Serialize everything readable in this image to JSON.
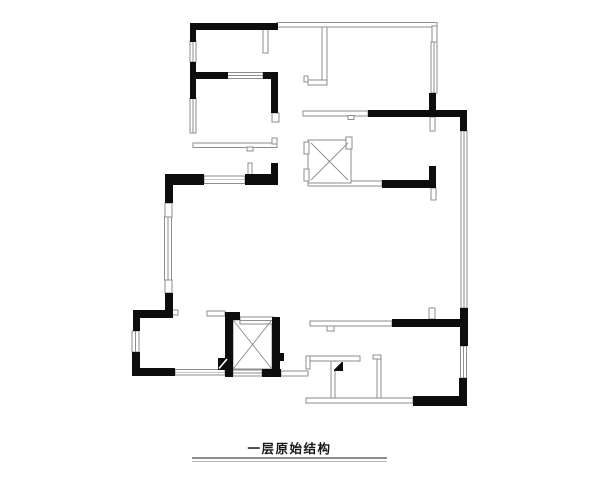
{
  "title": {
    "text": "一层原始结构"
  },
  "colors": {
    "wall": "#0d0d0d",
    "line": "#8e8e8e",
    "bg": "#ffffff",
    "title": "#1a1a1a",
    "ul1": "#8f8f8f",
    "ul2": "#b5b5b5"
  },
  "plan": {
    "walls": [
      {
        "x": 190,
        "y": 23,
        "w": 88,
        "h": 7,
        "name": "wall-top-room1"
      },
      {
        "x": 190,
        "y": 29,
        "w": 6,
        "h": 13,
        "name": "wall-left-upper-a"
      },
      {
        "x": 190,
        "y": 62,
        "w": 6,
        "h": 37,
        "name": "wall-left-upper-b"
      },
      {
        "x": 190,
        "y": 72,
        "w": 38,
        "h": 7,
        "name": "wall-room1-south-left"
      },
      {
        "x": 263,
        "y": 72,
        "w": 15,
        "h": 7,
        "name": "wall-room1-south-right"
      },
      {
        "x": 271,
        "y": 72,
        "w": 7,
        "h": 41,
        "name": "wall-room1-east"
      },
      {
        "x": 165,
        "y": 174,
        "w": 39,
        "h": 11,
        "name": "wall-corridor-left"
      },
      {
        "x": 245,
        "y": 174,
        "w": 33,
        "h": 11,
        "name": "wall-corridor-right"
      },
      {
        "x": 271,
        "y": 163,
        "w": 7,
        "h": 12,
        "name": "wall-corridor-stub-up"
      },
      {
        "x": 165,
        "y": 182,
        "w": 8,
        "h": 21,
        "name": "wall-left-mid-a"
      },
      {
        "x": 165,
        "y": 293,
        "w": 8,
        "h": 25,
        "name": "wall-left-mid-b"
      },
      {
        "x": 133,
        "y": 310,
        "w": 39,
        "h": 8,
        "name": "wall-room4-north"
      },
      {
        "x": 133,
        "y": 310,
        "w": 7,
        "h": 21,
        "name": "wall-room4-west-a"
      },
      {
        "x": 132,
        "y": 352,
        "w": 8,
        "h": 24,
        "name": "wall-room4-west-b"
      },
      {
        "x": 133,
        "y": 368,
        "w": 42,
        "h": 8,
        "name": "wall-room4-south"
      },
      {
        "x": 225,
        "y": 312,
        "w": 8,
        "h": 65,
        "name": "wall-shaft2-west"
      },
      {
        "x": 225,
        "y": 312,
        "w": 15,
        "h": 8,
        "name": "wall-shaft2-north-corner"
      },
      {
        "x": 272,
        "y": 317,
        "w": 8,
        "h": 60,
        "name": "wall-shaft2-east"
      },
      {
        "x": 280,
        "y": 353,
        "w": 4,
        "h": 8,
        "name": "wall-shaft2-east-tab"
      },
      {
        "x": 262,
        "y": 369,
        "w": 19,
        "h": 8,
        "name": "wall-shaft2-south"
      },
      {
        "x": 218,
        "y": 358,
        "w": 10,
        "h": 12,
        "name": "column-shaft2-corner"
      },
      {
        "x": 392,
        "y": 319,
        "w": 70,
        "h": 8,
        "name": "wall-lower-mid-black"
      },
      {
        "x": 460,
        "y": 308,
        "w": 8,
        "h": 38,
        "name": "wall-right-a"
      },
      {
        "x": 459,
        "y": 378,
        "w": 8,
        "h": 28,
        "name": "wall-right-b"
      },
      {
        "x": 413,
        "y": 396,
        "w": 50,
        "h": 10,
        "name": "wall-bottom-right"
      },
      {
        "x": 368,
        "y": 110,
        "w": 99,
        "h": 7,
        "name": "wall-upper-mid-black"
      },
      {
        "x": 460,
        "y": 110,
        "w": 7,
        "h": 21,
        "name": "wall-right-top-corner"
      },
      {
        "x": 429,
        "y": 93,
        "w": 7,
        "h": 19,
        "name": "wall-entry-top"
      },
      {
        "x": 429,
        "y": 166,
        "w": 7,
        "h": 22,
        "name": "wall-entry-stub"
      },
      {
        "x": 382,
        "y": 180,
        "w": 54,
        "h": 8,
        "name": "wall-hall-black"
      },
      {
        "x": 334,
        "y": 362,
        "w": 9,
        "h": 9,
        "name": "column-terrace"
      }
    ],
    "windows": [
      {
        "x": 190,
        "y": 41,
        "w": 6,
        "h": 21,
        "o": "v",
        "name": "window-left-1"
      },
      {
        "x": 190,
        "y": 98,
        "w": 6,
        "h": 35,
        "o": "v",
        "name": "window-left-2"
      },
      {
        "x": 227,
        "y": 72.5,
        "w": 36,
        "h": 6,
        "o": "h",
        "name": "window-room1-south"
      },
      {
        "x": 204,
        "y": 176,
        "w": 41,
        "h": 7.5,
        "o": "h",
        "name": "window-corridor-wall"
      },
      {
        "x": 164.5,
        "y": 217,
        "w": 7,
        "h": 63,
        "o": "v",
        "name": "window-left-mid"
      },
      {
        "x": 132,
        "y": 331,
        "w": 7,
        "h": 21,
        "o": "v",
        "name": "window-room4-west"
      },
      {
        "x": 175,
        "y": 369.5,
        "w": 50,
        "h": 5.5,
        "o": "h",
        "name": "window-room4-south"
      },
      {
        "x": 240,
        "y": 317,
        "w": 33,
        "h": 7,
        "o": "h",
        "name": "window-shaft2-north"
      },
      {
        "x": 233,
        "y": 370,
        "w": 29,
        "h": 6,
        "o": "h",
        "name": "window-shaft2-south"
      },
      {
        "x": 431,
        "y": 42,
        "w": 6,
        "h": 51,
        "o": "v",
        "name": "window-right-top"
      },
      {
        "x": 461,
        "y": 131,
        "w": 6,
        "h": 177,
        "o": "v",
        "name": "window-right-long"
      },
      {
        "x": 460.5,
        "y": 346,
        "w": 6,
        "h": 32,
        "o": "v",
        "name": "window-right-low"
      }
    ],
    "stubs": [
      {
        "x": 165,
        "y": 203,
        "w": 7,
        "h": 14,
        "name": "stub-left-mid-cap-top"
      },
      {
        "x": 165,
        "y": 280,
        "w": 7,
        "h": 13,
        "name": "stub-left-mid-cap-bottom"
      },
      {
        "x": 272,
        "y": 113,
        "w": 7,
        "h": 9,
        "name": "stub-room1-east-cap"
      },
      {
        "x": 172,
        "y": 310,
        "w": 6,
        "h": 5,
        "name": "stub-room4-door-jamb"
      },
      {
        "x": 248,
        "y": 163,
        "w": 4,
        "h": 12,
        "name": "stub-corridor-tick"
      },
      {
        "x": 430,
        "y": 117,
        "w": 5,
        "h": 14,
        "name": "stub-entry-below-wall"
      },
      {
        "x": 431,
        "y": 188,
        "w": 5,
        "h": 12,
        "name": "stub-hall-below-wall"
      },
      {
        "x": 429,
        "y": 308,
        "w": 6,
        "h": 11,
        "name": "stub-above-lower-wall"
      },
      {
        "x": 207,
        "y": 311,
        "w": 18,
        "h": 5,
        "name": "stub-shaft2-west-link"
      }
    ],
    "outlines": [
      {
        "x": 277,
        "y": 22.5,
        "w": 160,
        "h": 4.5,
        "name": "outline-top-line"
      },
      {
        "x": 432,
        "y": 26,
        "w": 5,
        "h": 17,
        "name": "outline-top-right-corner"
      },
      {
        "x": 263,
        "y": 29,
        "w": 5,
        "h": 24,
        "name": "outline-room1-stub"
      },
      {
        "x": 322,
        "y": 27,
        "w": 5,
        "h": 55,
        "name": "outline-partition-vert"
      },
      {
        "x": 308,
        "y": 80,
        "w": 19,
        "h": 5,
        "name": "outline-partition-foot"
      },
      {
        "x": 304,
        "y": 76,
        "w": 4,
        "h": 6,
        "name": "outline-partition-foot-tick"
      },
      {
        "x": 193,
        "y": 143,
        "w": 84,
        "h": 4.5,
        "name": "outline-room2-partition"
      },
      {
        "x": 247,
        "y": 147,
        "w": 6,
        "h": 4,
        "name": "outline-room2-door-notch"
      },
      {
        "x": 272,
        "y": 138,
        "w": 5,
        "h": 6,
        "name": "outline-room2-hook"
      },
      {
        "x": 303,
        "y": 111,
        "w": 65,
        "h": 5,
        "name": "outline-corridor-upper"
      },
      {
        "x": 348,
        "y": 115.5,
        "w": 6,
        "h": 4,
        "name": "outline-corridor-upper-notch"
      },
      {
        "x": 310,
        "y": 321,
        "w": 82,
        "h": 5,
        "name": "outline-corridor-lower"
      },
      {
        "x": 327,
        "y": 326,
        "w": 7,
        "h": 5,
        "name": "outline-corridor-lower-notch"
      },
      {
        "x": 308,
        "y": 181,
        "w": 74,
        "h": 5,
        "name": "outline-hall-line"
      },
      {
        "x": 306,
        "y": 356,
        "w": 54,
        "h": 5,
        "name": "outline-terrace-partition"
      },
      {
        "x": 306,
        "y": 356,
        "w": 4,
        "h": 13,
        "name": "outline-terrace-partition-cap"
      },
      {
        "x": 331,
        "y": 361,
        "w": 4,
        "h": 40,
        "name": "outline-terrace-v1"
      },
      {
        "x": 377,
        "y": 359,
        "w": 4,
        "h": 43,
        "name": "outline-terrace-v2"
      },
      {
        "x": 373,
        "y": 355,
        "w": 8,
        "h": 4,
        "name": "outline-terrace-v2-hook"
      },
      {
        "x": 306,
        "y": 398,
        "w": 107,
        "h": 5,
        "name": "outline-terrace-bottom"
      },
      {
        "x": 281,
        "y": 371,
        "w": 27,
        "h": 5,
        "name": "outline-terrace-bridge"
      },
      {
        "x": 308,
        "y": 140,
        "w": 43,
        "h": 43,
        "name": "outline-shaft1-box"
      },
      {
        "x": 304,
        "y": 142,
        "w": 5,
        "h": 12,
        "name": "outline-shaft1-jamb-top"
      },
      {
        "x": 304,
        "y": 169,
        "w": 5,
        "h": 12,
        "name": "outline-shaft1-jamb-bottom"
      },
      {
        "x": 346,
        "y": 137,
        "w": 6,
        "h": 12,
        "name": "outline-shaft1-tab"
      },
      {
        "x": 233,
        "y": 320,
        "w": 39,
        "h": 49,
        "name": "outline-shaft2-box"
      }
    ],
    "crosses": [
      {
        "x1": 311,
        "y1": 143,
        "x2": 348,
        "y2": 180,
        "name": "shaft1-diagonal-1"
      },
      {
        "x1": 348,
        "y1": 143,
        "x2": 311,
        "y2": 180,
        "name": "shaft1-diagonal-2"
      },
      {
        "x1": 233.5,
        "y1": 320.5,
        "x2": 271.5,
        "y2": 368.5,
        "name": "shaft2-diagonal-1"
      },
      {
        "x1": 271.5,
        "y1": 320.5,
        "x2": 233.5,
        "y2": 368.5,
        "name": "shaft2-diagonal-2"
      }
    ],
    "marks": [
      {
        "type": "line",
        "x1": 219,
        "y1": 368.5,
        "x2": 227,
        "y2": 359,
        "name": "column-corner-slash"
      },
      {
        "type": "polygon",
        "points": "334,362 341.5,362 334,369.5",
        "name": "column-terrace-notch"
      }
    ]
  }
}
